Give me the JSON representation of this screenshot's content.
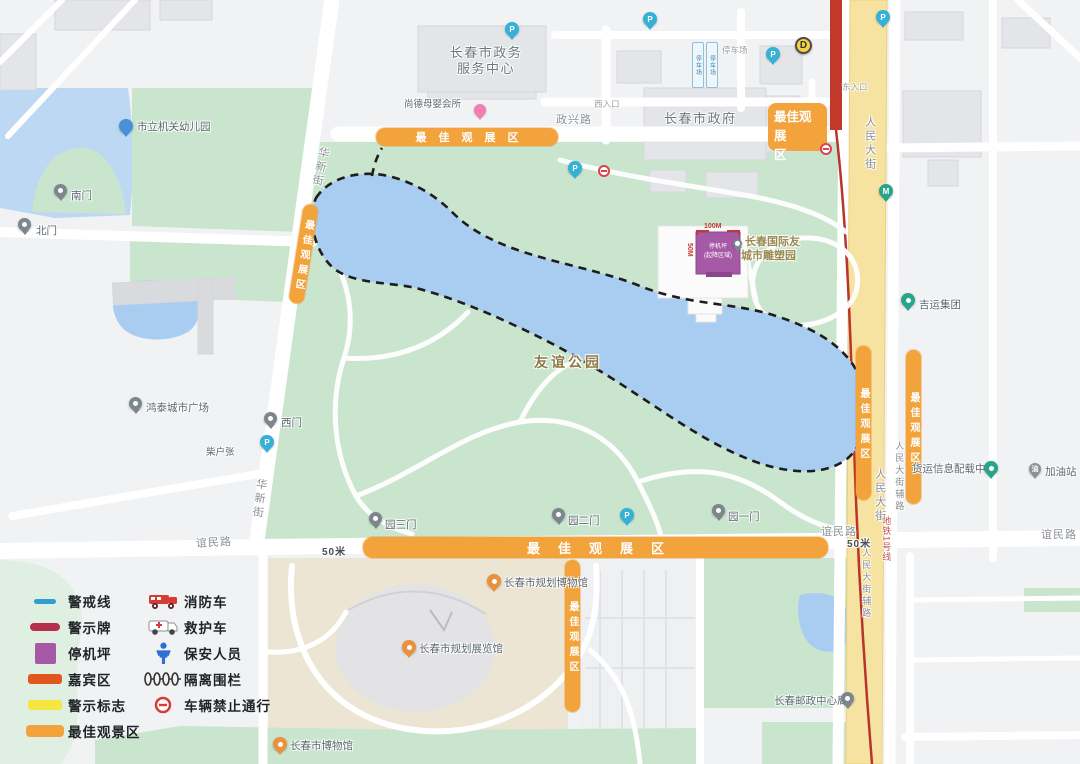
{
  "colors": {
    "accent_orange": "#F2A33C",
    "road_yellow": "#F6E3A1",
    "water_blue": "#A9CDF0",
    "park_green": "#C9E5CE",
    "metro_red": "#B8342C",
    "legend_cordon_blue": "#2F9FD0",
    "legend_sign_red": "#B5304A",
    "legend_helipad_purple": "#A65AA6",
    "legend_guest_orange": "#E2571F",
    "legend_warning_yellow": "#F5E73F"
  },
  "legend": {
    "left": [
      {
        "icon": "cordon-line-swatch",
        "sw": "sw-cordon",
        "label": "警戒线"
      },
      {
        "icon": "warning-sign-swatch",
        "sw": "sw-sign",
        "label": "警示牌"
      },
      {
        "icon": "helipad-swatch",
        "sw": "sw-heli",
        "label": "停机坪"
      },
      {
        "icon": "guest-area-swatch",
        "sw": "sw-guest",
        "label": "嘉宾区"
      },
      {
        "icon": "warning-mark-swatch",
        "sw": "sw-warn",
        "label": "警示标志"
      },
      {
        "icon": "best-viewing-swatch",
        "sw": "sw-view",
        "label": "最佳观景区"
      }
    ],
    "right": [
      {
        "icon": "fire-truck-icon",
        "ic": "fire",
        "label": "消防车"
      },
      {
        "icon": "ambulance-icon",
        "ic": "amb",
        "label": "救护车"
      },
      {
        "icon": "security-guard-icon",
        "ic": "guard",
        "label": "保安人员"
      },
      {
        "icon": "isolation-fence-icon",
        "ic": "fence",
        "label": "隔离围栏"
      },
      {
        "icon": "no-vehicles-icon",
        "ic": "noveh",
        "label": "车辆禁止通行"
      }
    ]
  },
  "zones": {
    "bars": [
      {
        "name": "viewing-zone-north",
        "label": "最佳观展区",
        "x": 376,
        "y": 128,
        "w": 170,
        "h": 18,
        "orient": "h",
        "fs": 11,
        "ls": 12
      },
      {
        "name": "viewing-zone-south",
        "label": "最佳观展区",
        "x": 363,
        "y": 537,
        "w": 447,
        "h": 21,
        "orient": "h",
        "fs": 13,
        "ls": 18
      },
      {
        "name": "viewing-zone-south-vertical",
        "label": "最佳观展区",
        "x": 565,
        "y": 560,
        "w": 15,
        "h": 152,
        "orient": "v"
      },
      {
        "name": "viewing-zone-east-1",
        "label": "最佳观展区",
        "x": 856,
        "y": 346,
        "w": 15,
        "h": 154,
        "orient": "v"
      },
      {
        "name": "viewing-zone-east-2",
        "label": "最佳观展区",
        "x": 906,
        "y": 350,
        "w": 15,
        "h": 154,
        "orient": "v"
      },
      {
        "name": "viewing-zone-west-diagonal",
        "label": "最佳观展区",
        "x": 296,
        "y": 204,
        "w": 15,
        "h": 100,
        "orient": "v",
        "rot": 9
      }
    ],
    "box": {
      "name": "viewing-zone-northeast-box",
      "label": "最佳观展\n区",
      "x": 768,
      "y": 103,
      "w": 59,
      "h": 48
    }
  },
  "helipad": {
    "width_label": "100M",
    "height_label": "50M",
    "caption": "停机坪\n(起降区域)"
  },
  "map": {
    "labels": [
      {
        "t": "市立机关幼儿园",
        "x": 137,
        "y": 121,
        "c": "poi"
      },
      {
        "t": "尚德母婴会所",
        "x": 404,
        "y": 99,
        "c": "poi s10"
      },
      {
        "t": "长春市政务\n服务中心",
        "x": 441,
        "y": 45,
        "c": "building ctr",
        "w": 90
      },
      {
        "t": "长春市政府",
        "x": 664,
        "y": 111,
        "c": "building"
      },
      {
        "t": "政兴路",
        "x": 556,
        "y": 114,
        "c": "road"
      },
      {
        "t": "西入口",
        "x": 594,
        "y": 99,
        "c": "ent"
      },
      {
        "t": "东入口",
        "x": 842,
        "y": 82,
        "c": "ent"
      },
      {
        "t": "停车场",
        "x": 722,
        "y": 45,
        "c": "ent"
      },
      {
        "t": "北门",
        "x": 36,
        "y": 225,
        "c": "poi"
      },
      {
        "t": "南门",
        "x": 71,
        "y": 190,
        "c": "poi"
      },
      {
        "t": "西门",
        "x": 281,
        "y": 417,
        "c": "poi"
      },
      {
        "t": "鸿泰城市广场",
        "x": 146,
        "y": 402,
        "c": "poi"
      },
      {
        "t": "柴户张",
        "x": 206,
        "y": 447,
        "c": "poi s10"
      },
      {
        "t": "园三门",
        "x": 385,
        "y": 519,
        "c": "poi"
      },
      {
        "t": "园二门",
        "x": 568,
        "y": 515,
        "c": "poi"
      },
      {
        "t": "园一门",
        "x": 728,
        "y": 511,
        "c": "poi"
      },
      {
        "t": "友谊公园",
        "x": 534,
        "y": 354,
        "c": "park"
      },
      {
        "t": "长春国际友",
        "x": 745,
        "y": 236,
        "c": "olive"
      },
      {
        "t": "城市雕塑园",
        "x": 741,
        "y": 250,
        "c": "olive"
      },
      {
        "t": "吉运集团",
        "x": 919,
        "y": 299,
        "c": "poi"
      },
      {
        "t": "货运信息配载中心",
        "x": 912,
        "y": 463,
        "c": "poi"
      },
      {
        "t": "加油站",
        "x": 1045,
        "y": 466,
        "c": "poi"
      },
      {
        "t": "长春市规划博物馆",
        "x": 504,
        "y": 577,
        "c": "poi"
      },
      {
        "t": "长春市规划展览馆",
        "x": 419,
        "y": 643,
        "c": "poi"
      },
      {
        "t": "长春市博物馆",
        "x": 290,
        "y": 740,
        "c": "poi"
      },
      {
        "t": "长春邮政中心局",
        "x": 774,
        "y": 695,
        "c": "poi"
      },
      {
        "t": "谊民路",
        "x": 196,
        "y": 537,
        "c": "road",
        "r": -3
      },
      {
        "t": "谊民路",
        "x": 821,
        "y": 526,
        "c": "road"
      },
      {
        "t": "谊民路",
        "x": 1041,
        "y": 529,
        "c": "road"
      },
      {
        "t": "50米",
        "x": 322,
        "y": 547,
        "c": "dist"
      },
      {
        "t": "50米",
        "x": 847,
        "y": 539,
        "c": "dist"
      },
      {
        "t": "华新街",
        "x": 310,
        "y": 146,
        "c": "vroad",
        "r": 12,
        "h": 62
      },
      {
        "t": "华新街",
        "x": 250,
        "y": 478,
        "c": "vroad",
        "r": 7,
        "h": 62
      },
      {
        "t": "人民大街",
        "x": 862,
        "y": 116,
        "c": "vroad",
        "h": 80
      },
      {
        "t": "人民大街",
        "x": 872,
        "y": 468,
        "c": "vroad",
        "h": 74
      },
      {
        "t": "人民大街辅路",
        "x": 893,
        "y": 441,
        "c": "vroad s9",
        "h": 92
      },
      {
        "t": "人民大街辅路",
        "x": 860,
        "y": 548,
        "c": "vroad s9",
        "h": 92
      },
      {
        "t": "地铁1号线",
        "x": 880,
        "y": 516,
        "c": "vroad metro",
        "h": 58
      },
      {
        "t": "100M",
        "x": 704,
        "y": 223,
        "c": "redm"
      },
      {
        "t": "50M",
        "x": 684,
        "y": 243,
        "c": "redm vert",
        "h": 22
      },
      {
        "t": "停机坪\n(起降区域)",
        "x": 698,
        "y": 243,
        "c": "heli",
        "w": 40
      }
    ],
    "pins": [
      {
        "k": "p",
        "x": 505,
        "y": 22,
        "txt": "P"
      },
      {
        "k": "p",
        "x": 643,
        "y": 12,
        "txt": "P"
      },
      {
        "k": "p",
        "x": 766,
        "y": 47,
        "txt": "P"
      },
      {
        "k": "p",
        "x": 876,
        "y": 10,
        "txt": "P"
      },
      {
        "k": "p",
        "x": 568,
        "y": 161,
        "txt": "P"
      },
      {
        "k": "p",
        "x": 620,
        "y": 508,
        "txt": "P"
      },
      {
        "k": "p",
        "x": 260,
        "y": 435,
        "txt": "P"
      },
      {
        "k": "g",
        "x": 18,
        "y": 218
      },
      {
        "k": "g",
        "x": 54,
        "y": 184
      },
      {
        "k": "g",
        "x": 264,
        "y": 412
      },
      {
        "k": "g",
        "x": 369,
        "y": 512
      },
      {
        "k": "g",
        "x": 552,
        "y": 508
      },
      {
        "k": "g",
        "x": 712,
        "y": 504
      },
      {
        "k": "g",
        "x": 129,
        "y": 397
      },
      {
        "k": "g",
        "x": 841,
        "y": 692
      },
      {
        "k": "g mini",
        "x": 733,
        "y": 239
      },
      {
        "k": "pk",
        "x": 474,
        "y": 104
      },
      {
        "k": "bird",
        "x": 119,
        "y": 119
      },
      {
        "k": "o",
        "x": 487,
        "y": 574
      },
      {
        "k": "o",
        "x": 402,
        "y": 640
      },
      {
        "k": "o",
        "x": 273,
        "y": 737
      },
      {
        "k": "gr",
        "x": 901,
        "y": 293
      },
      {
        "k": "gr",
        "x": 984,
        "y": 461
      },
      {
        "k": "gr",
        "x": 879,
        "y": 184,
        "txt": "M"
      },
      {
        "k": "gas",
        "x": 1029,
        "y": 463,
        "txt": "油"
      },
      {
        "k": "d",
        "x": 795,
        "y": 37,
        "txt": "D"
      },
      {
        "k": "ne",
        "x": 598,
        "y": 165
      },
      {
        "k": "ne",
        "x": 820,
        "y": 143
      }
    ],
    "parking_tags": [
      {
        "t": "停车场",
        "x": 692,
        "y": 42
      },
      {
        "t": "停车场",
        "x": 706,
        "y": 42
      }
    ]
  }
}
